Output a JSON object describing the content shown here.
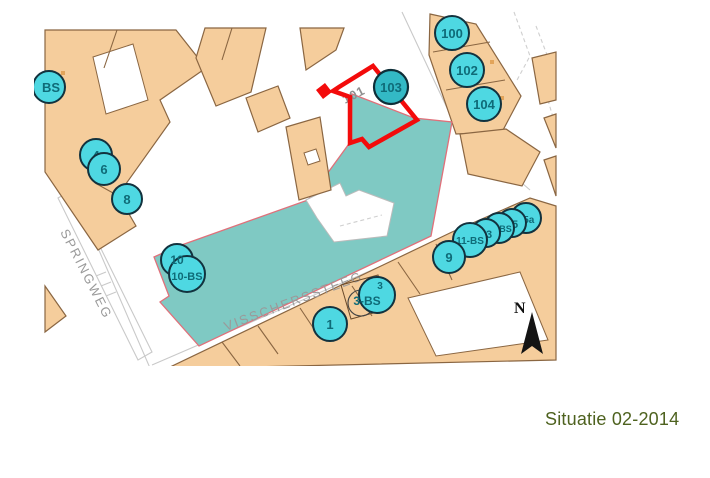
{
  "caption": "Situatie 02-2014",
  "map": {
    "streets": {
      "springweg": "SPRINGWEG",
      "visscherssteeg": "VISSCHERSSTEEG"
    },
    "north": "N",
    "parcel_number": "101",
    "markers": {
      "bs": "BS",
      "h4": "4",
      "h6": "6",
      "h8": "8",
      "h10": "10",
      "h10bs": "10-BS",
      "h1": "1",
      "h3": "3",
      "h3bs": "3-BS",
      "h9": "9",
      "h11bs": "11-BS",
      "h13": "13",
      "h13bs": "13-BS",
      "h15": "15",
      "h15a": "15a",
      "h100": "100",
      "h102": "102",
      "h104": "104",
      "h103": "103"
    },
    "colors": {
      "building": "#F5CD9C",
      "building_outline": "#8A6642",
      "highlight_building": "#7FC9C3",
      "highlight_outline": "#E0707A",
      "selection": "#F30B0B",
      "marker_fill": "#4ED8E2",
      "marker_selected_fill": "#33B9C5",
      "marker_text": "#0F6B78",
      "street_text": "#9A9A9A",
      "caption_text": "#4E621F"
    }
  }
}
